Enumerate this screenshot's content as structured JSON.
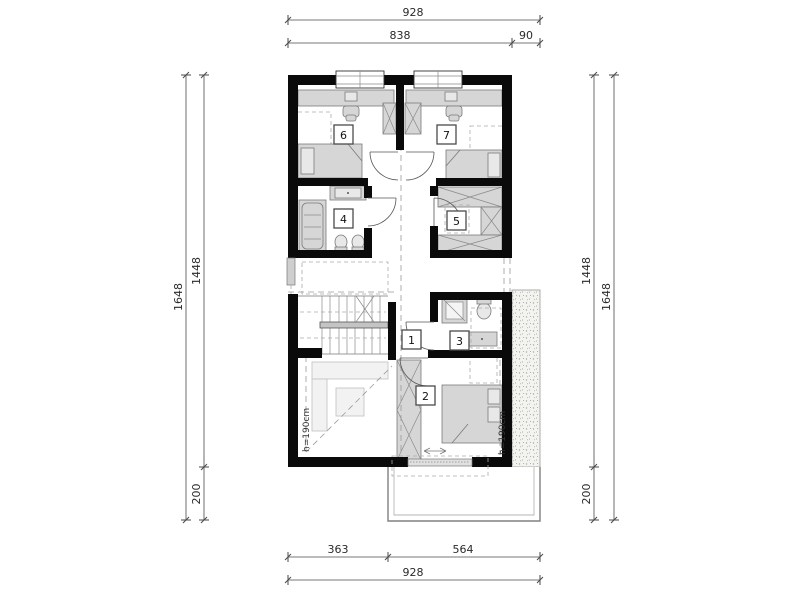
{
  "drawing": {
    "type": "architectural-floor-plan",
    "floor": "attic / first floor plan"
  },
  "dimensions": {
    "top_total": "928",
    "top_main": "838",
    "top_side": "90",
    "left_outer": "1648",
    "left_upper": "1448",
    "left_lower": "200",
    "right_upper": "1448",
    "right_lower": "200",
    "right_outer": "1648",
    "bottom_left": "363",
    "bottom_right": "564",
    "bottom_total": "928"
  },
  "rooms": {
    "r1": "1",
    "r2": "2",
    "r3": "3",
    "r4": "4",
    "r5": "5",
    "r6": "6",
    "r7": "7"
  },
  "annotations": {
    "height_left": "h=190cm",
    "height_right": "h=190cm"
  },
  "colors": {
    "wall": "#0a0a0a",
    "furniture": "#d6d6d6",
    "dash_line": "#9a9a9a",
    "dimension_text": "#2a2a2a",
    "background": "#ffffff"
  }
}
